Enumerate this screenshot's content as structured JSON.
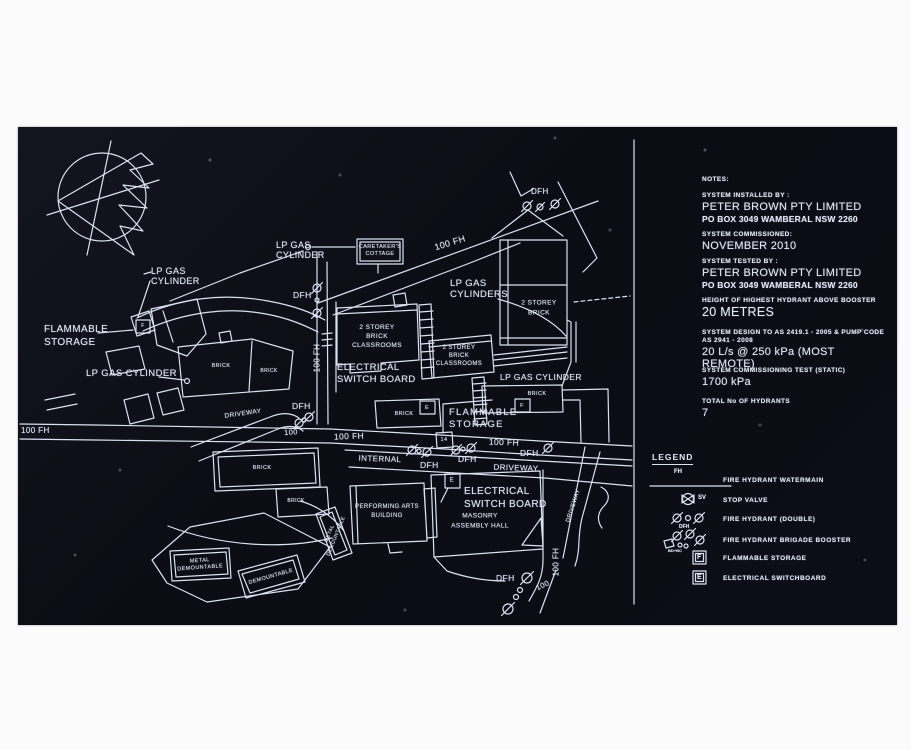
{
  "colors": {
    "line": "#dce1f2",
    "text": "#e4e8f6",
    "signbg": "#0c0d16",
    "photo": "#fbfbfc"
  },
  "notes": {
    "title": "NOTES:",
    "entries": [
      {
        "label": "SYSTEM INSTALLED BY :",
        "value": "PETER BROWN PTY LIMITED",
        "sub": "PO BOX 3049 WAMBERAL NSW 2260"
      },
      {
        "label": "SYSTEM COMMISSIONED:",
        "value": "NOVEMBER 2010"
      },
      {
        "label": "SYSTEM TESTED BY :",
        "value": "PETER BROWN PTY LIMITED",
        "sub": "PO BOX 3049 WAMBERAL NSW 2260"
      },
      {
        "label": "HEIGHT OF HIGHEST HYDRANT ABOVE BOOSTER",
        "value": "20 METRES"
      },
      {
        "label": "SYSTEM  DESIGN TO AS 2419.1 - 2005 & PUMP CODE",
        "label2": "AS 2941 - 2008",
        "value": "20 L/s @ 250 kPa (MOST REMOTE)"
      },
      {
        "label": "SYSTEM  COMMISSIONING TEST (STATIC)",
        "value": "1700 kPa"
      },
      {
        "label": "TOTAL No OF HYDRANTS",
        "value": "7"
      }
    ]
  },
  "legend": {
    "title": "LEGEND",
    "items": [
      {
        "icon": "fire-hydrant-watermain-icon",
        "sym": "FH",
        "label": "FIRE HYDRANT WATERMAIN"
      },
      {
        "icon": "stop-valve-icon",
        "sym": "SV",
        "label": "STOP VALVE"
      },
      {
        "icon": "fire-hydrant-double-icon",
        "sym": "DFH",
        "label": "FIRE HYDRANT (DOUBLE)"
      },
      {
        "icon": "fire-hydrant-brigade-booster-icon",
        "sym": "BD+BC",
        "label": "FIRE HYDRANT BRIGADE BOOSTER"
      },
      {
        "icon": "flammable-storage-icon",
        "sym": "F",
        "label": "FLAMMABLE STORAGE"
      },
      {
        "icon": "electrical-switchboard-icon",
        "sym": "E",
        "label": "ELECTRICAL SWITCHBOARD"
      }
    ]
  },
  "map": {
    "labels": [
      {
        "n": "lp-gas-cylinder-label-top",
        "t": "LP GAS\nCYLINDER",
        "x": 276,
        "y": 240,
        "fs": 9
      },
      {
        "n": "caretakers-cottage-label",
        "t": "CARETAKER'S\nCOTTAGE",
        "cx": 380,
        "cy": 251,
        "fs": 5.5,
        "c": 1,
        "lh": 1.25
      },
      {
        "n": "fh-100-diagonal",
        "t": "100 FH",
        "cx": 450,
        "cy": 243,
        "fs": 9,
        "rot": -17,
        "c": 1
      },
      {
        "n": "dfh-label-top",
        "t": "DFH",
        "x": 531,
        "y": 187,
        "fs": 8
      },
      {
        "n": "lp-gas-cylinder-label-left",
        "t": "LP GAS\nCYLINDER",
        "x": 151,
        "y": 266,
        "fs": 9
      },
      {
        "n": "flammable-storage-label-left",
        "t": "FLAMMABLE\nSTORAGE",
        "x": 44,
        "y": 324,
        "fs": 10,
        "lh": 1.25
      },
      {
        "n": "lp-gas-cylinder-label-bottomleft",
        "t": "LP GAS CYLINDER",
        "x": 86,
        "y": 369,
        "fs": 9.5
      },
      {
        "n": "dfh-label-mid",
        "t": "DFH",
        "x": 293,
        "y": 291,
        "fs": 8.5
      },
      {
        "n": "lp-gas-cylinders-label",
        "t": "LP GAS\nCYLINDERS",
        "x": 450,
        "y": 279,
        "fs": 9.5
      },
      {
        "n": "classrooms1-label",
        "t": "2 STOREY\nBRICK\nCLASSROOMS",
        "cx": 377,
        "cy": 337,
        "fs": 6.5,
        "c": 1,
        "lh": 1.35
      },
      {
        "n": "classrooms2-label",
        "t": "2 STOREY\nBRICK\nCLASSROOMS",
        "cx": 459,
        "cy": 356,
        "fs": 6,
        "c": 1,
        "lh": 1.35
      },
      {
        "n": "two-storey-brick-label",
        "t": "2 STOREY\nBRICK",
        "cx": 539,
        "cy": 309,
        "fs": 6.5,
        "c": 1,
        "lh": 1.6
      },
      {
        "n": "electrical-switch-board-label-1",
        "t": "ELECTRICAL\nSWITCH BOARD",
        "x": 337,
        "y": 362,
        "fs": 9.5,
        "lh": 1.3
      },
      {
        "n": "brick-label-a",
        "t": "BRICK",
        "cx": 221,
        "cy": 366,
        "fs": 5.5,
        "c": 1
      },
      {
        "n": "brick-label-b",
        "t": "BRICK",
        "cx": 269,
        "cy": 372,
        "fs": 5,
        "c": 1
      },
      {
        "n": "fh-100-vertical-1",
        "t": "100 FH",
        "cx": 317,
        "cy": 358,
        "fs": 8,
        "rot": -90,
        "c": 1
      },
      {
        "n": "lp-gas-cylinder-label-right",
        "t": "LP GAS CYLINDER",
        "x": 500,
        "y": 373,
        "fs": 8.5
      },
      {
        "n": "brick-label-right",
        "t": "BRICK",
        "cx": 537,
        "cy": 394,
        "fs": 5.5,
        "c": 1
      },
      {
        "n": "brick-label-center",
        "t": "BRICK",
        "cx": 404,
        "cy": 414,
        "fs": 5.5,
        "c": 1
      },
      {
        "n": "flammable-storage-label-center",
        "t": "FLAMMABLE\nSTORAGE",
        "x": 449,
        "y": 407,
        "fs": 9.5,
        "lh": 1.3,
        "ls": 1.2
      },
      {
        "n": "fh-100-left-edge",
        "t": "100 FH",
        "x": 21,
        "y": 426,
        "fs": 8
      },
      {
        "n": "label-100-left",
        "t": "100",
        "cx": 291,
        "cy": 433,
        "fs": 7.5,
        "rot": -4,
        "c": 1
      },
      {
        "n": "fh-100-mid",
        "t": "100 FH",
        "cx": 349,
        "cy": 437,
        "fs": 8.5,
        "rot": -2,
        "c": 1
      },
      {
        "n": "driveway-label-left",
        "t": "DRIVEWAY",
        "cx": 243,
        "cy": 414,
        "fs": 6.5,
        "rot": -8,
        "c": 1
      },
      {
        "n": "dfh-label-left2",
        "t": "DFH",
        "x": 292,
        "y": 402,
        "fs": 8.5
      },
      {
        "n": "label-14",
        "t": "14",
        "cx": 444,
        "cy": 440,
        "fs": 5.5,
        "c": 1
      },
      {
        "n": "fh-100-internal",
        "t": "100 FH",
        "cx": 504,
        "cy": 443,
        "fs": 8.5,
        "rot": 2,
        "c": 1
      },
      {
        "n": "dfh-internal-right",
        "t": "DFH",
        "x": 520,
        "y": 449,
        "fs": 8.5
      },
      {
        "n": "dfh-internal-mid",
        "t": "DFH",
        "x": 458,
        "y": 455,
        "fs": 8.5
      },
      {
        "n": "dfh-internal-left",
        "t": "DFH",
        "x": 420,
        "y": 461,
        "fs": 8.5
      },
      {
        "n": "internal-label",
        "t": "INTERNAL",
        "cx": 380,
        "cy": 459,
        "fs": 8,
        "rot": 2,
        "c": 1
      },
      {
        "n": "driveway-label-internal",
        "t": "DRIVEWAY",
        "cx": 516,
        "cy": 468,
        "fs": 8,
        "rot": 2,
        "c": 1
      },
      {
        "n": "electrical-switch-board-label-2",
        "t": "ELECTRICAL\nSWITCH BOARD",
        "x": 464,
        "y": 485,
        "fs": 10,
        "lh": 1.3
      },
      {
        "n": "masonry-label",
        "t": "MASONRY\nASSEMBLY HALL",
        "cx": 480,
        "cy": 521,
        "fs": 6.5,
        "c": 1,
        "lh": 1.5
      },
      {
        "n": "performing-arts-label",
        "t": "PERFORMING ARTS\nBUILDING",
        "cx": 387,
        "cy": 512,
        "fs": 6,
        "c": 1,
        "lh": 1.5
      },
      {
        "n": "brick-label-big",
        "t": "BRICK",
        "cx": 262,
        "cy": 468,
        "fs": 5.5,
        "c": 1
      },
      {
        "n": "brick-label-small2",
        "t": "BRICK",
        "cx": 296,
        "cy": 502,
        "fs": 5,
        "c": 1
      },
      {
        "n": "metal-demountable-rotated",
        "t": "METAL\nDEMOUNTABLE",
        "cx": 333,
        "cy": 535,
        "fs": 5,
        "rot": -68,
        "c": 1,
        "lh": 1.3
      },
      {
        "n": "metal-demountable-label",
        "t": "METAL\nDEMOUNTABLE",
        "cx": 200,
        "cy": 565,
        "fs": 5.5,
        "rot": -4,
        "c": 1,
        "lh": 1.3
      },
      {
        "n": "demountable-label",
        "t": "DEMOUNTABLE",
        "cx": 271,
        "cy": 577,
        "fs": 5.5,
        "rot": -16,
        "c": 1
      },
      {
        "n": "driveway-label-right",
        "t": "DRIVEWAY",
        "cx": 574,
        "cy": 506,
        "fs": 6,
        "rot": -72,
        "c": 1
      },
      {
        "n": "fh-100-vertical-2",
        "t": "100 FH",
        "cx": 556,
        "cy": 562,
        "fs": 8,
        "rot": -90,
        "c": 1
      },
      {
        "n": "dfh-label-bottom",
        "t": "DFH",
        "x": 496,
        "y": 574,
        "fs": 8.5
      },
      {
        "n": "label-100-bottom",
        "t": "100",
        "cx": 543,
        "cy": 586,
        "fs": 7.5,
        "rot": -25,
        "c": 1
      },
      {
        "n": "f-mark-left",
        "t": "F",
        "cx": 143,
        "cy": 327,
        "fs": 5,
        "c": 1
      },
      {
        "n": "f-mark-right",
        "t": "F",
        "cx": 522,
        "cy": 406,
        "fs": 5.5,
        "c": 1
      },
      {
        "n": "e-mark-center",
        "t": "E",
        "cx": 427,
        "cy": 408,
        "fs": 5.5,
        "c": 1
      },
      {
        "n": "e-mark-hall",
        "t": "E",
        "cx": 452,
        "cy": 481,
        "fs": 6,
        "c": 1
      }
    ]
  }
}
